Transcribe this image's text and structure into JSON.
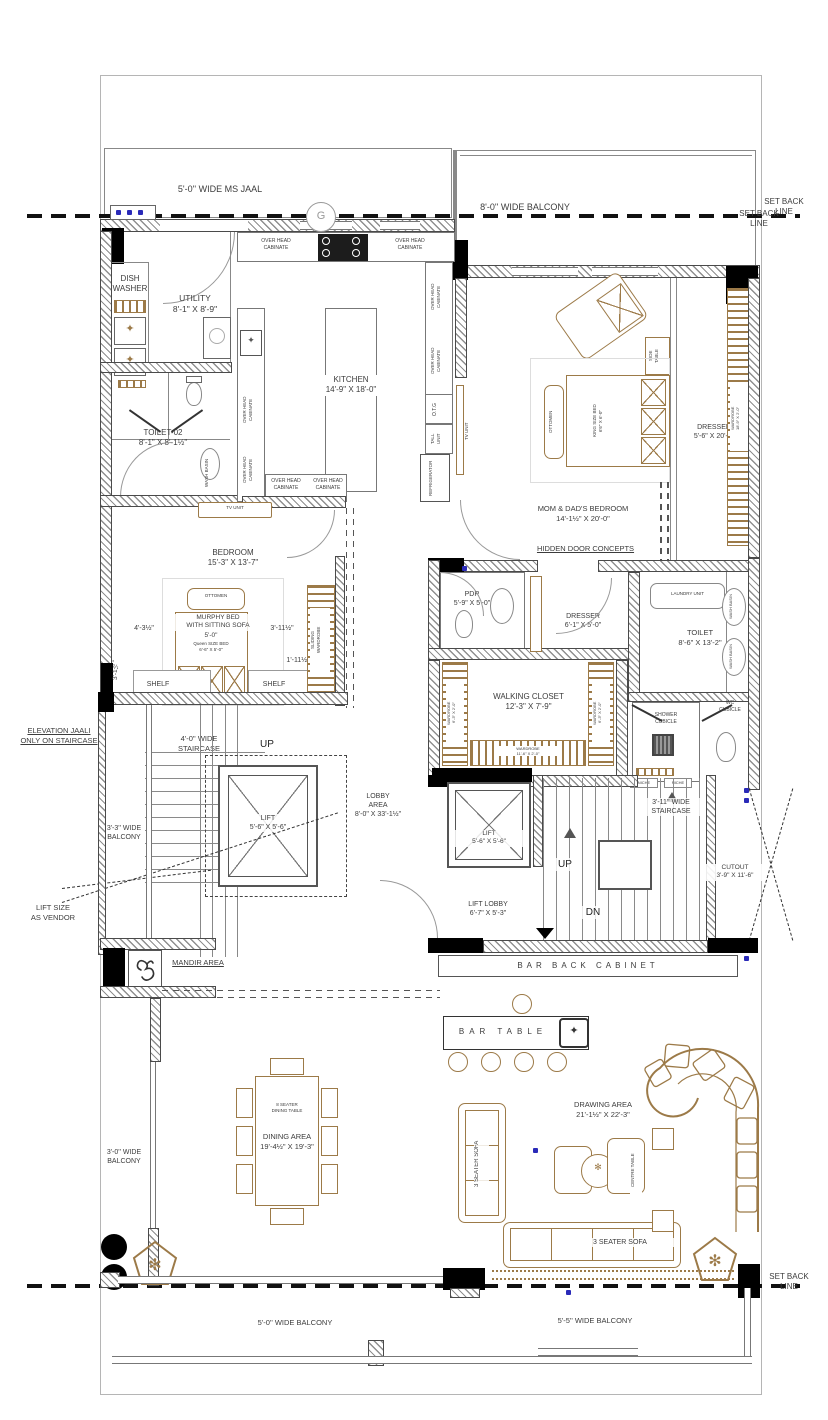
{
  "colors": {
    "furniture": "#9c7a48",
    "wall": "#4a4a4a",
    "text": "#3c3c3c",
    "column": "#000000",
    "electrical": "#2a2ab8"
  },
  "labels": {
    "ms_jaal": "5'-0'' WIDE MS JAAL",
    "balcony_top": "8'-0'' WIDE BALCONY",
    "setback": "SET BACK\nLINE",
    "g_mark": "G",
    "overhead": "OVER HEAD\nCABINATE",
    "dish_washer": "DISH\nWASHER",
    "utility": "UTILITY\n8'-1\" X 8'-9\"",
    "kitchen": "KITCHEN\n14'-9\" X 18'-0\"",
    "toilet02": "TOILET-02\n8'-1\" X 8'-1½\"",
    "wash_basin": "WASH BASIN",
    "otg": "O.T.G",
    "tall_unit": "TALL\nUNIT",
    "refrigerator": "REFRIGERATOR",
    "tv_unit": "TV UNIT",
    "momdad": "MOM & DAD'S BEDROOM\n14'-1½\" X 20'-0\"",
    "hidden_door": "HIDDEN DOOR CONCEPTS",
    "side_table": "SIDE\nTABLE",
    "ottomen": "OTTOMEN",
    "king_bed": "KING SIZE BED\n6'6\" X 6'-0\"",
    "dresser_long": "DRESSER\n5'-6\" X 20'-0\"",
    "wardrobe_right": "WARDROBE\n18'-9\" X 2'-0\"",
    "bedroom": "BEDROOM\n15'-3\" X 13'-7\"",
    "murphy": "MURPHY BED\nWITH SITTING SOFA",
    "dim_5_0": "5'-0\"",
    "queen": "Queen SIZE BED\n6'-6\" X 5'-0\"",
    "dim_4_3": "4'-3½\"",
    "dim_3_11": "3'-11½\"",
    "dim_3_1": "3'-1½\"",
    "dim_1_11": "1'-11½\"",
    "dim_2_0": "2'-0\"",
    "shelf": "SHELF",
    "sliding_wardrobe": "SLIDING\nWARDROBE",
    "staircase_4": "4'-0'' WIDE\nSTAIRCASE",
    "up": "UP",
    "dn": "DN",
    "balcony_33": "3'-3'' WIDE\nBALCONY",
    "elevation_jaali": "ELEVATION JAALI\nONLY ON STAIRCASE",
    "lift_size": "LIFT SIZE\nAS VENDOR",
    "lift": "LIFT\n5'-6\" X 5'-6\"",
    "lobby_area": "LOBBY\nAREA\n8'-0\" X 33'-1½\"",
    "mandir": "MANDIR AREA",
    "pdr": "PDR\n5'-9\" X 5'-0\"",
    "dresser_small": "DRESSER\n6'-1\" X 5'-0\"",
    "laundry": "LAUNDRY UNIT",
    "toilet": "TOILET\n8'-6\" X 13'-2\"",
    "walking_closet": "WALKING CLOSET\n12'-3\" X 7'-9\"",
    "wardrobe_bottom": "WARDROBE\n11'-6\" X 2'-0\"",
    "wardrobe_side": "WARDROBE\n6'-3\" X 2'-0\"",
    "shower": "SHOWER\nCUBICLE",
    "wc": "WC\nCUBICLE",
    "niche": "NICHE",
    "staircase_311": "3'-11'' WIDE\nSTAIRCASE",
    "cutout": "CUTOUT\n3'-9\" X 11'-6\"",
    "lift_lobby": "LIFT LOBBY\n6'-7\" X 5'-3\"",
    "bar_back": "BAR BACK CABINET",
    "bar_table": "BAR TABLE",
    "dining_table8": "8 SEATER\nDINING TABLE",
    "dining_area": "DINING AREA\n19'-4½\" X 19'-3\"",
    "balcony_30": "3'-0'' WIDE\nBALCONY",
    "drawing_area": "DRAWING AREA\n21'-1½\" X 22'-3\"",
    "sofa3": "3 SEATER SOFA",
    "centre_table": "CENTRE TABLE",
    "balcony_50": "5'-0'' WIDE BALCONY",
    "balcony_55": "5'-5'' WIDE BALCONY"
  }
}
